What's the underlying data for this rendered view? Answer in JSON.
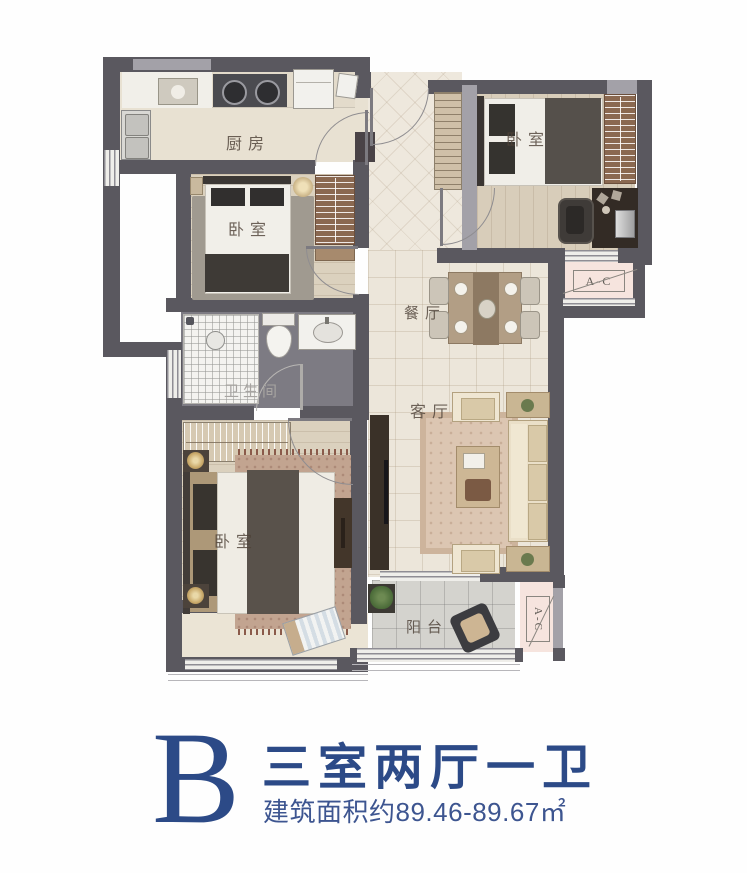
{
  "floor_plan": {
    "rooms": [
      {
        "id": "kitchen",
        "label": "厨房"
      },
      {
        "id": "bedroom_north",
        "label": "卧室"
      },
      {
        "id": "bedroom_east",
        "label": "卧室"
      },
      {
        "id": "dining_room",
        "label": "餐厅"
      },
      {
        "id": "bathroom",
        "label": "卫生间"
      },
      {
        "id": "living_room",
        "label": "客厅"
      },
      {
        "id": "bedroom_master",
        "label": "卧室"
      },
      {
        "id": "balcony",
        "label": "阳台"
      }
    ],
    "ac_units": [
      {
        "id": "ac_east",
        "label": "A-C"
      },
      {
        "id": "ac_south",
        "label": "A-C"
      }
    ]
  },
  "title_block": {
    "unit_letter": "B",
    "layout_name": "三室两厅一卫",
    "area_text": "建筑面积约89.46-89.67㎡"
  },
  "colors": {
    "accent_navy": "#2c4a87",
    "wall_dark": "#5a585f",
    "wall_light": "#a3a1a8",
    "ac_pink": "#f6e4de",
    "bath_floor": "#7d7b83"
  }
}
